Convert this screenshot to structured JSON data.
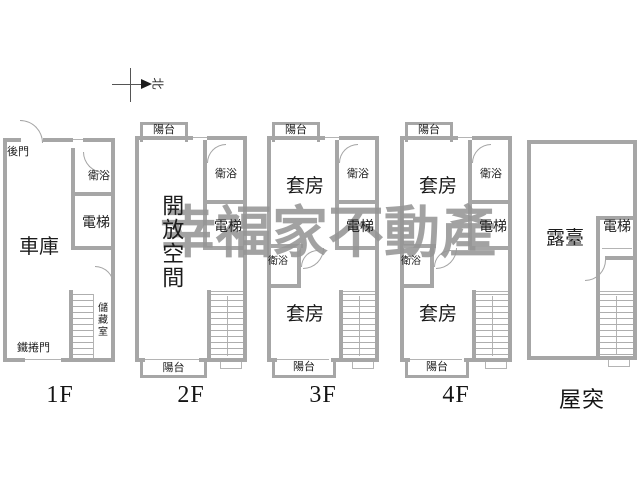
{
  "watermark": {
    "text": "幸福家不動產"
  },
  "compass": {
    "north_label": "北"
  },
  "floors": [
    {
      "id": "f1",
      "label": "1F",
      "rooms": {
        "back_door": "後門",
        "bath": "衛浴",
        "elevator": "電梯",
        "garage": "車庫",
        "storage": "儲藏室",
        "rolling_door": "鐵捲門"
      }
    },
    {
      "id": "f2",
      "label": "2F",
      "rooms": {
        "balcony_top": "陽台",
        "bath": "衛浴",
        "elevator": "電梯",
        "open_space": "開放空間",
        "balcony_bottom": "陽台"
      }
    },
    {
      "id": "f3",
      "label": "3F",
      "rooms": {
        "balcony_top": "陽台",
        "suite_top": "套房",
        "bath_top": "衛浴",
        "elevator": "電梯",
        "bath_mid": "衛浴",
        "suite_bottom": "套房",
        "balcony_bottom": "陽台"
      }
    },
    {
      "id": "f4",
      "label": "4F",
      "rooms": {
        "balcony_top": "陽台",
        "suite_top": "套房",
        "bath_top": "衛浴",
        "elevator": "電梯",
        "bath_mid": "衛浴",
        "suite_bottom": "套房",
        "balcony_bottom": "陽台"
      }
    },
    {
      "id": "roof",
      "label": "屋突",
      "rooms": {
        "terrace": "露臺",
        "elevator": "電梯"
      }
    }
  ],
  "colors": {
    "wall": "#a6a6a6",
    "thin_line": "#b4b4b4",
    "text": "#1c1c1c",
    "watermark": "#969696",
    "background": "#ffffff"
  }
}
